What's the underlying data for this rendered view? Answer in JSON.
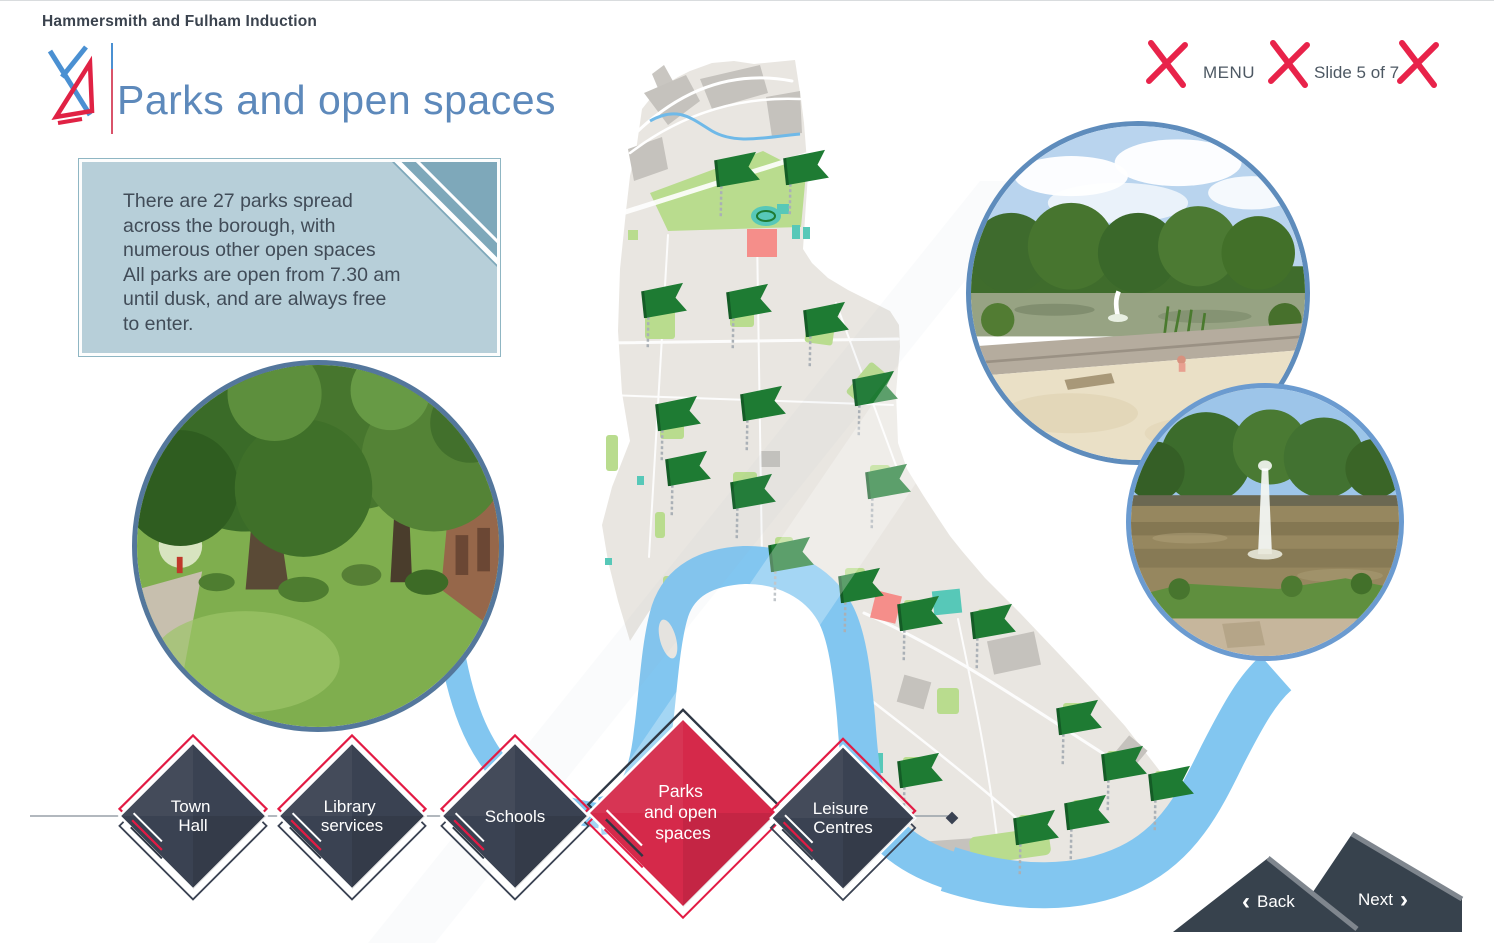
{
  "header": {
    "app_title": "Hammersmith and Fulham Induction"
  },
  "topbar": {
    "menu_label": "MENU",
    "slide_indicator": "Slide 5 of 7",
    "logo_glyph": "hf-red-x-icon"
  },
  "slide": {
    "title": "Parks and open spaces",
    "info_box": {
      "lines": [
        "There are 27 parks spread",
        "across the borough,  with",
        "numerous other open spaces",
        "All parks are open from 7.30 am",
        "until dusk,  and are always free",
        "to enter."
      ]
    }
  },
  "nav": {
    "back_label": "Back",
    "next_label": "Next",
    "back_chevron": "‹",
    "next_chevron": "›",
    "items": [
      {
        "id": "town-hall",
        "lines": [
          "Town",
          "Hall"
        ],
        "active": false
      },
      {
        "id": "library-services",
        "lines": [
          "Library",
          "services"
        ],
        "active": false
      },
      {
        "id": "schools",
        "lines": [
          "Schools"
        ],
        "active": false
      },
      {
        "id": "parks-open-spaces",
        "lines": [
          "Parks",
          "and open",
          "spaces"
        ],
        "active": true
      },
      {
        "id": "leisure-centres",
        "lines": [
          "Leisure",
          "Centres"
        ],
        "active": false
      }
    ]
  },
  "map": {
    "flag_icon": "park-flag-icon",
    "flag_color": "#1e7b33",
    "flags": [
      {
        "x": 737,
        "y": 171
      },
      {
        "x": 806,
        "y": 169
      },
      {
        "x": 664,
        "y": 302
      },
      {
        "x": 749,
        "y": 303
      },
      {
        "x": 826,
        "y": 321
      },
      {
        "x": 678,
        "y": 415
      },
      {
        "x": 763,
        "y": 405
      },
      {
        "x": 875,
        "y": 390
      },
      {
        "x": 688,
        "y": 470
      },
      {
        "x": 753,
        "y": 493
      },
      {
        "x": 888,
        "y": 483
      },
      {
        "x": 791,
        "y": 556
      },
      {
        "x": 861,
        "y": 587
      },
      {
        "x": 920,
        "y": 615
      },
      {
        "x": 993,
        "y": 623
      },
      {
        "x": 920,
        "y": 772
      },
      {
        "x": 1079,
        "y": 719
      },
      {
        "x": 1124,
        "y": 765
      },
      {
        "x": 1171,
        "y": 785
      },
      {
        "x": 1087,
        "y": 814
      },
      {
        "x": 1036,
        "y": 829
      }
    ]
  },
  "colors": {
    "accent_red": "#da2a4a",
    "dark_slate": "#3a4252",
    "river_blue": "#82c6f0",
    "land_beige": "#e9e6e1",
    "park_green": "#b9dc8e",
    "flag_green": "#1e7b33",
    "title_blue": "#5d89bb",
    "infobox_bg": "#b7cfd9"
  }
}
